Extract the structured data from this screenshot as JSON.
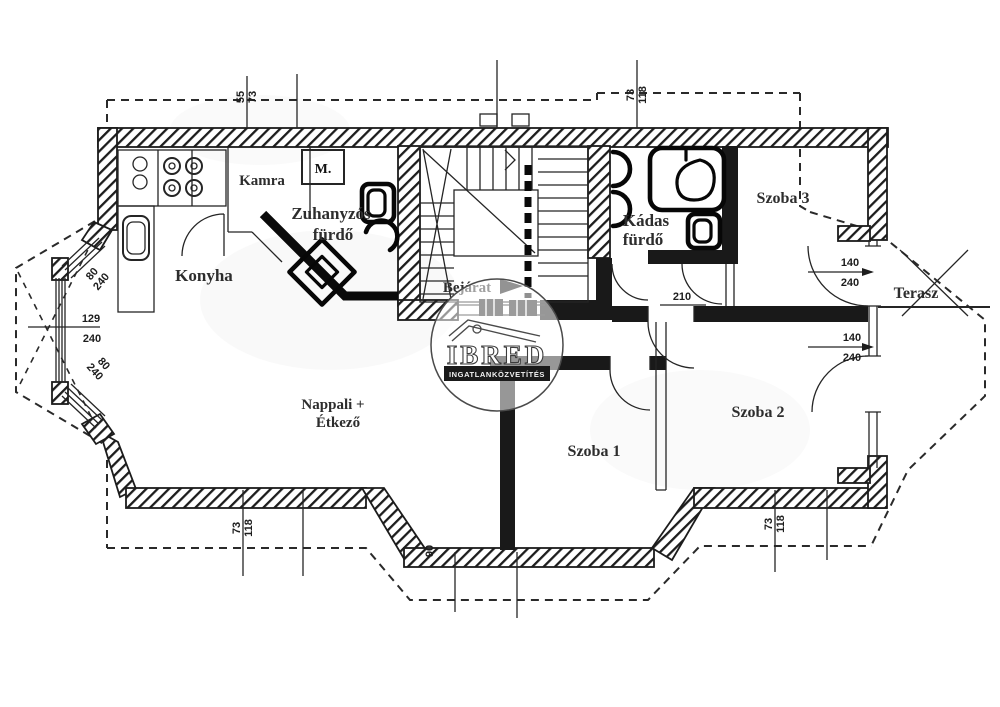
{
  "plan": {
    "rooms": {
      "konyha": "Konyha",
      "kamra": "Kamra",
      "zuhanyzos_1": "Zuhanyzós",
      "zuhanyzos_2": "fürdő",
      "kadas_1": "Kádas",
      "kadas_2": "fürdő",
      "bejarat": "Bejárat",
      "nappali_1": "Nappali +",
      "nappali_2": "Étkező",
      "szoba1": "Szoba 1",
      "szoba2": "Szoba 2",
      "szoba3": "Szoba 3",
      "terasz": "Terasz"
    },
    "fixtures": {
      "washing_machine": "M."
    },
    "dimensions": {
      "top_left_a": "55",
      "top_left_b": "73",
      "top_right_a": "73",
      "top_right_b": "118",
      "bottom_left_a": "73",
      "bottom_left_b": "118",
      "bottom_right_a": "73",
      "bottom_right_b": "118",
      "bay_upper_a": "80",
      "bay_upper_b": "240",
      "bay_middle_a": "129",
      "bay_middle_b": "240",
      "bay_lower_a": "80",
      "bay_lower_b": "240",
      "terrace_upper_a": "140",
      "terrace_upper_b": "240",
      "terrace_lower_a": "140",
      "terrace_lower_b": "240",
      "door_height": "210",
      "entry_width": "90"
    },
    "watermark": {
      "brand": "IBRED",
      "subtitle": "INGATLANKÖZVETÍTÉS"
    },
    "colors": {
      "ink": "#1c1c1c",
      "paper": "#ffffff"
    }
  }
}
